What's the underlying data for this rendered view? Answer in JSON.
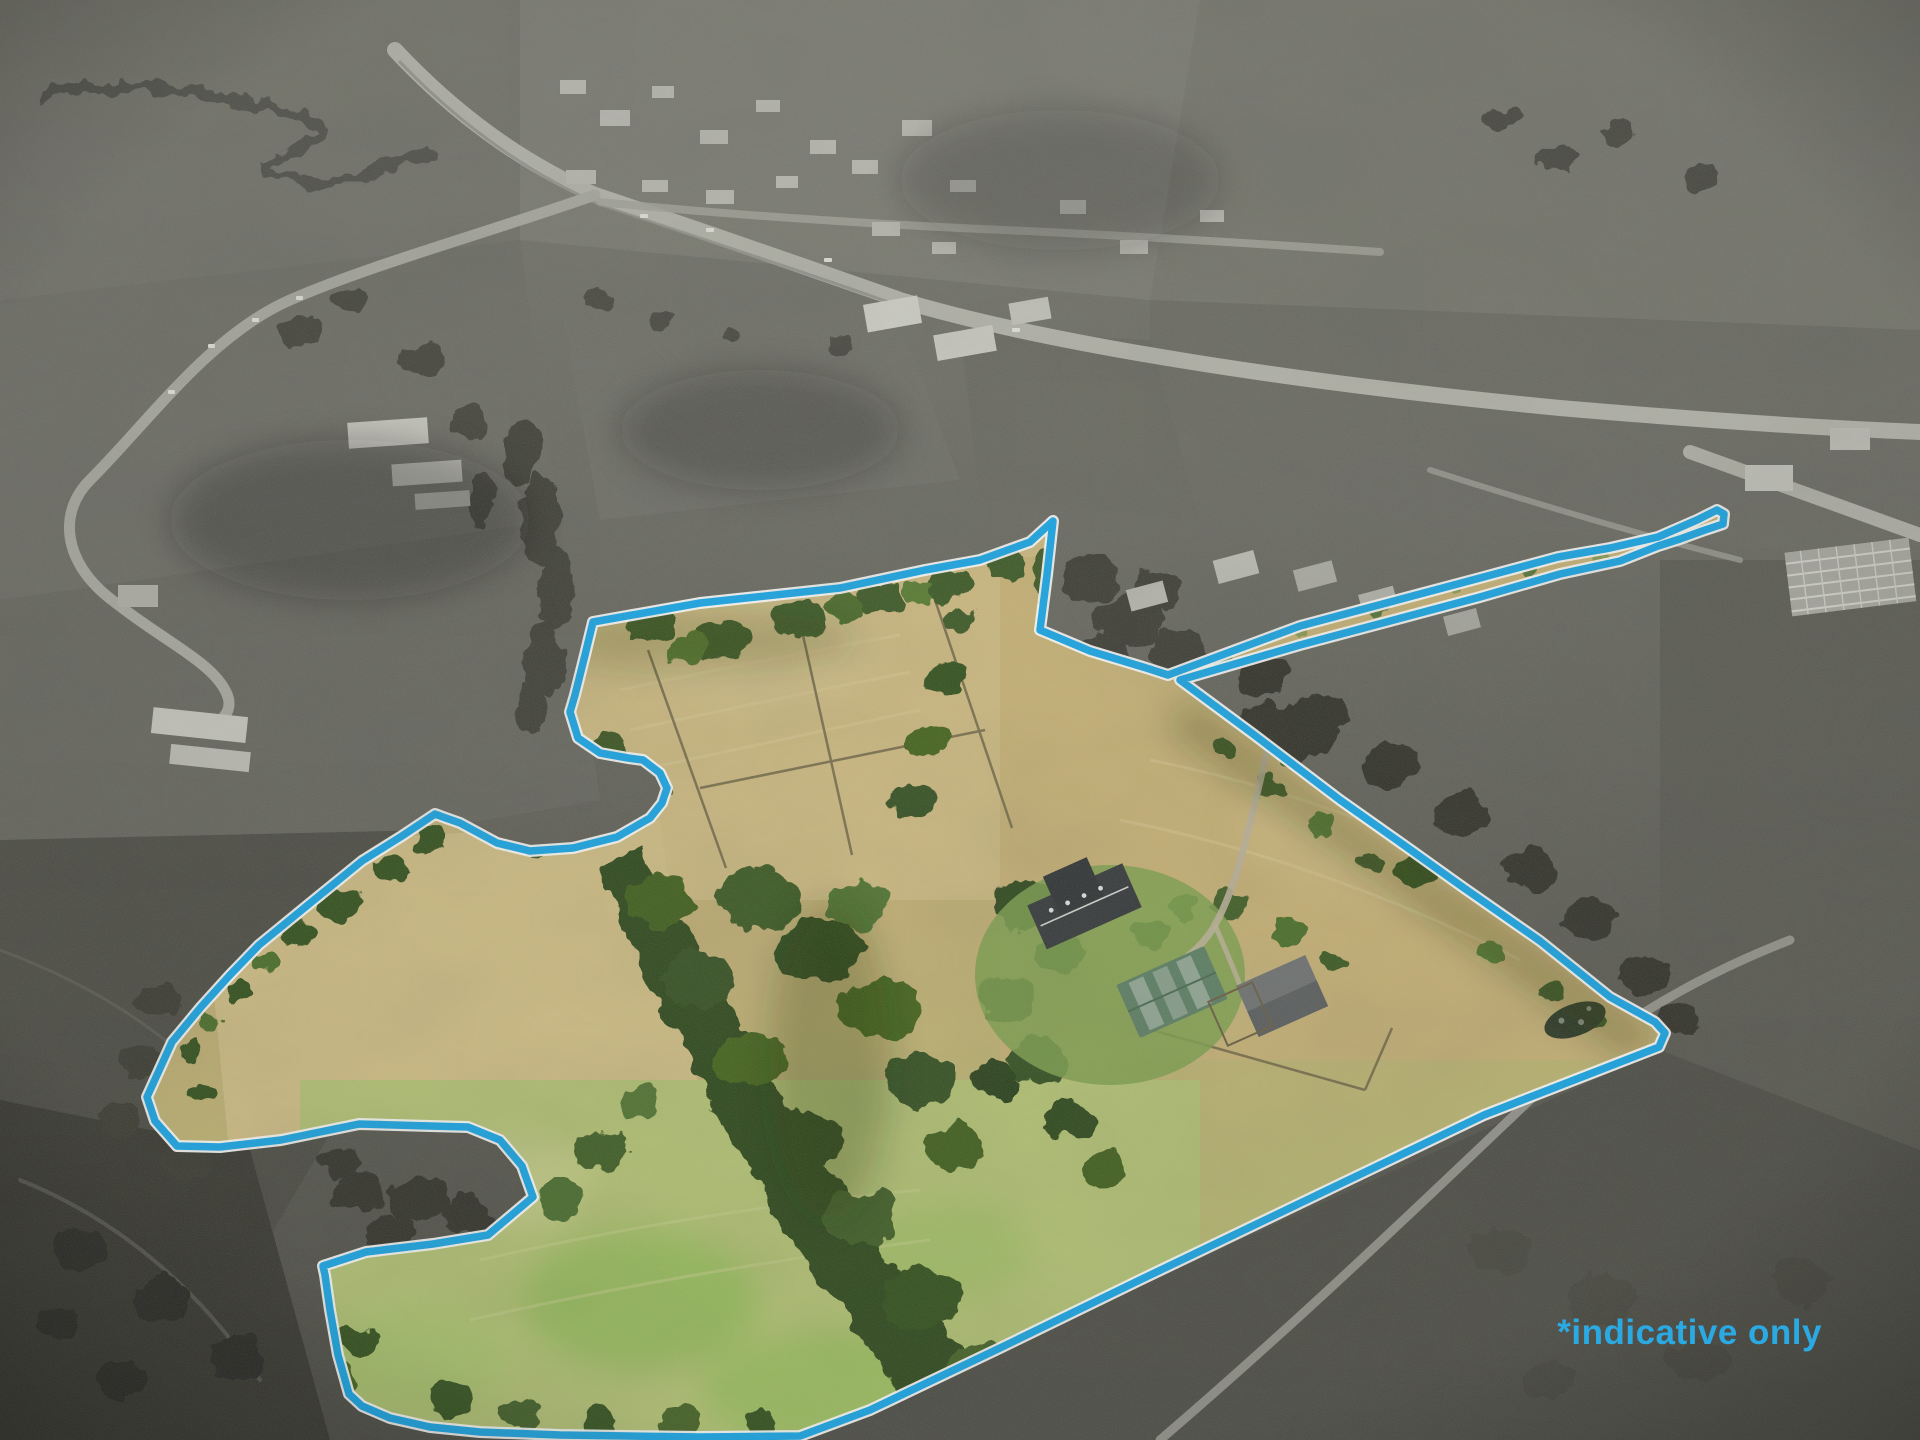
{
  "scene": {
    "kind": "aerial-drone-photo",
    "subject": "rural lifestyle property with homestead, barns, paddocks and shelterbelt trees",
    "treatment": "surroundings desaturated to grayscale; property land shown in colour inside an indicative boundary overlay"
  },
  "watermark": {
    "text": "*indicative only",
    "color": "#2aa9e2"
  },
  "boundary": {
    "color": "#17a7e9",
    "casing_color": "#ffffff"
  },
  "palette": {
    "outside_field_gray": "#6b6b63",
    "outside_dark_trees": "#33332c",
    "road_gray": "#b5b5ac",
    "paddock_tan": "#cbb67c",
    "pasture_green": "#b6c276",
    "bright_grass": "#8fbc55",
    "lawn_green": "#7fa24f",
    "tree_dark_green": "#2e481b",
    "house_roof": "#35383b",
    "barn_green_roof": "#5e8066",
    "barn_gray_roof": "#707374"
  }
}
